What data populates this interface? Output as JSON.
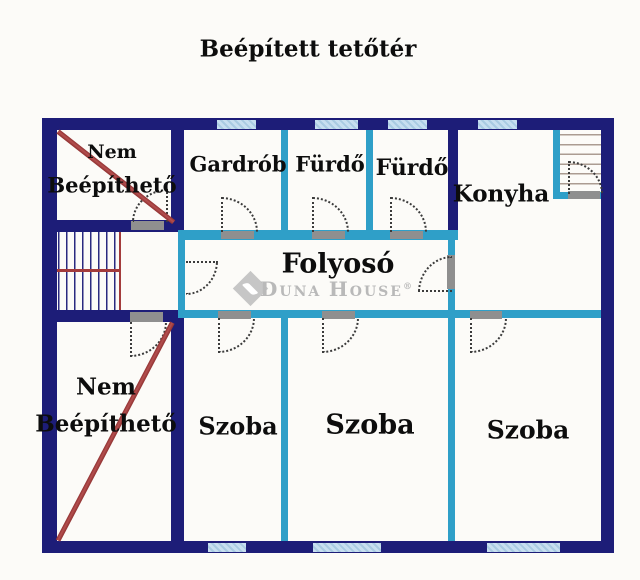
{
  "title": "Beépített tetőtér",
  "plan": {
    "rooms": [
      {
        "id": "nem-beepitheto-top",
        "line1": "Nem",
        "line2": "Beépíthető"
      },
      {
        "id": "gardrob",
        "label": "Gardrób"
      },
      {
        "id": "furdo-1",
        "label": "Fürdő"
      },
      {
        "id": "furdo-2",
        "label": "Fürdő"
      },
      {
        "id": "konyha",
        "label": "Konyha"
      },
      {
        "id": "folyoso",
        "label": "Folyosó"
      },
      {
        "id": "nem-beepitheto-bottom",
        "line1": "Nem",
        "line2": "Beépíthető"
      },
      {
        "id": "szoba-1",
        "label": "Szoba"
      },
      {
        "id": "szoba-2",
        "label": "Szoba"
      },
      {
        "id": "szoba-3",
        "label": "Szoba"
      }
    ],
    "features": {
      "staircases": 2,
      "doors": 11,
      "windows_top": 4,
      "windows_bottom": 3
    }
  },
  "watermark": {
    "d": "D",
    "una": "UNA",
    "h": "H",
    "ouse": "OUSE",
    "reg": "®"
  },
  "colors": {
    "wall": "#1d1d78",
    "partition": "#2f9fc8",
    "window": "#bcd6ea",
    "annotation_red": "#a33b3b",
    "door_sill": "#8f8f8f",
    "watermark": "#b9b9b9",
    "background": "#fcfbf8"
  }
}
